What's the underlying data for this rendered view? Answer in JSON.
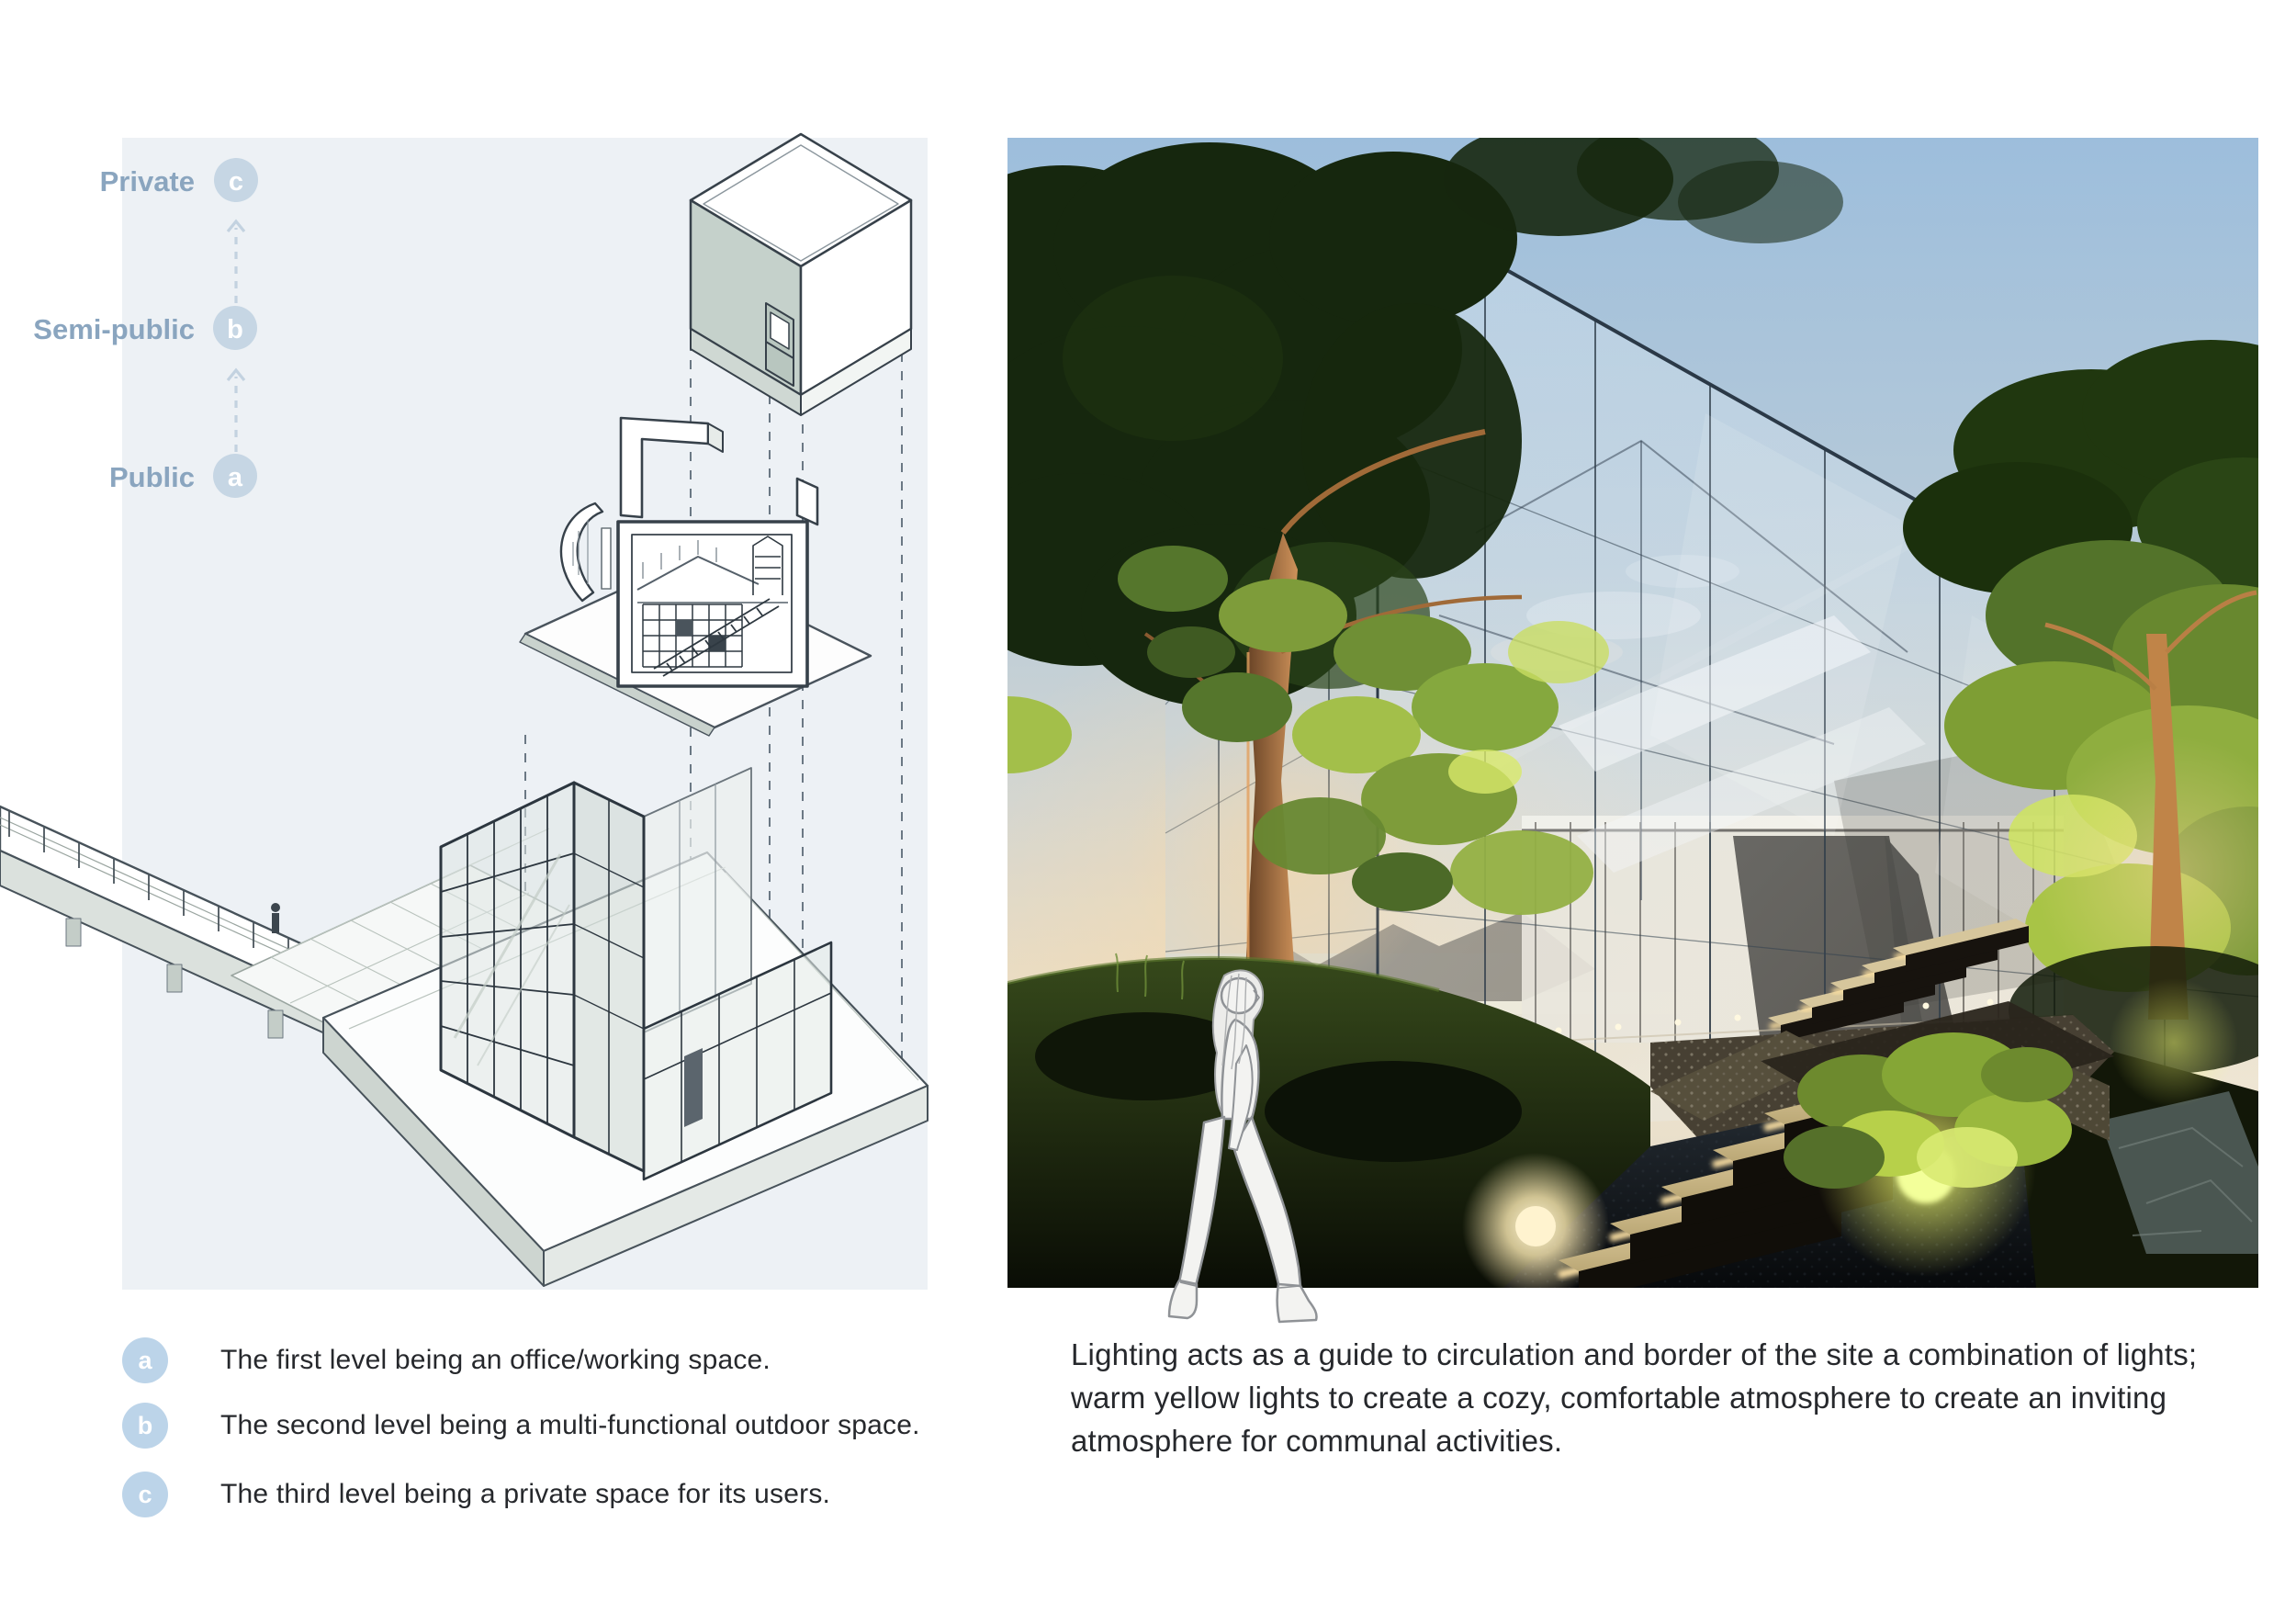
{
  "diagram": {
    "labels": [
      {
        "label": "Private",
        "letter": "c"
      },
      {
        "label": "Semi-public",
        "letter": "b"
      },
      {
        "label": "Public",
        "letter": "a"
      }
    ],
    "colors": {
      "panel_bg": "#edf1f5",
      "label_text": "#8aa5bf",
      "circle_fill": "#c6d6e4",
      "circle_letter": "#ffffff",
      "line_dark": "#37414a",
      "face_green": "#c5d1cb"
    }
  },
  "legend": {
    "items": [
      {
        "letter": "a",
        "text": "The first level being an office/working space."
      },
      {
        "letter": "b",
        "text": "The second level being a multi-functional outdoor space."
      },
      {
        "letter": "c",
        "text": "The third level being a private space for its users."
      }
    ],
    "circle_fill": "#bcd4e9",
    "text_color": "#26282c"
  },
  "caption": {
    "text": "Lighting acts as a guide to circulation and border of the site a combination of lights; warm yellow lights to create a cozy, comfortable atmosphere to create an inviting atmosphere for communal activities."
  },
  "photo": {
    "description": "Dusk render of a glass cube building among trees with warm step lighting and a sketched woman walking",
    "colors": {
      "sky_top": "#9dbedc",
      "horizon_warm": "#eee3cd",
      "foliage_lit": "#a3bf4a",
      "step_glow": "#ffe2a2",
      "bush_glow": "#f3ff9a",
      "paving_dark": "#0b0e11"
    }
  }
}
